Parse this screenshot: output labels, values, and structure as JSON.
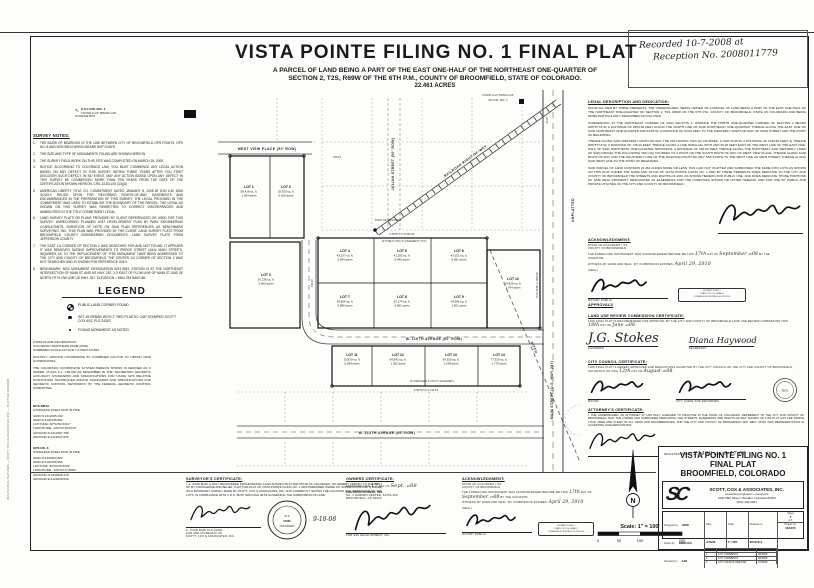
{
  "recording": {
    "line1": "Recorded 10-7-2008 at",
    "line2": "Reception No. 2008011779"
  },
  "header": {
    "title": "VISTA POINTE FILING NO. 1 FINAL PLAT",
    "subtitle1": "A PARCEL OF LAND BEING A PART OF THE EAST ONE-HALF OF THE NORTHEAST ONE-QUARTER OF",
    "subtitle2": "SECTION 2, T2S, R69W OF THE 6TH P.M., COUNTY OF BROOMFIELD, STATE OF COLORADO.",
    "acreage": "22.461 ACRES"
  },
  "corner_callout": {
    "line1": "N 1/4 COR. SEC. 2",
    "line2": "FOUND 3-1/4\" BRASS CAP",
    "line3": "IN RANGE BOX"
  },
  "plot_stamp": "08A37E FINAL PLAT.DWG — SCOTT, COX & ASSOCIATES, INC. — PLOTTED 9/18/2008",
  "survey_notes": {
    "heading": "SURVEY NOTES:",
    "items": [
      "THE BASIS OF BEARINGS IS THE LINE BETWEEN CITY OF BROOMFIELD GPS POINTS, GPS NO. 8 AND NGS BM13 WHICH BEARS N00°13'46\"E.",
      "THE SIZE AND TYPE OF MONUMENTS FOUND ARE SHOWN HEREON.",
      "THE SURVEY FIELD WORK ON THIS SITE WAS COMPLETED ON MARCH 18, 2008.",
      "NOTICE: ACCORDING TO COLORADO LAW, YOU MUST COMMENCE ANY LEGAL ACTION BASED ON ANY DEFECT IN THIS SURVEY WITHIN THREE YEARS AFTER YOU FIRST DISCOVER SUCH DEFECT. IN NO EVENT, MAY ANY ACTION BASED UPON ANY DEFECT IN THIS SURVEY BE COMMENCED MORE THAN TEN YEARS FROM THE DATE OF THE CERTIFICATION SHOWN HEREON. CRS-13-80-105 C(3)(a)",
      "AMERICAN LIBERTY TITLE CO. COMMITMENT DATED JANUARY 8, 2008 AT 8:00 A.M. WAS SOLELY RELIED UPON FOR RECORDED RIGHTS-OF-WAY, EASEMENTS AND ENCUMBRANCES IN THE PREPARATION OF THIS SURVEY. THE LEGAL PROVIDED IN THE COMMITMENT WAS USED TO ESTABLISH THE BOUNDARY OF THE PARCEL. THE LEGAL AS SHOWN ON THIS SURVEY WAS REWRITTEN TO CORRECT DISCREPANCIES AND AMBIGUITIES IN THE TITLE COMMITMENT LEGAL.",
      "LAND SURVEY PLATS OR PLANS PROVIDED BY CLIENT REFERENCED OR USED FOR THIS SURVEY: UNRECORDED PLANNED UNIT DEVELOPMENT PLAN BY PARK ENGINEERING CONSULTANTS, SURVEYOR OF NOTE ON SAID PLAN REFERENCED AS BENCHMARK SURVEYING, INC. THIS PLAN WAS PROVIDED BY THE CLIENT. LAND SURVEY PLATS FROM BROOMFIELD COUNTY ENGINEERING DOCUMENTS. LAND SURVEY PLATS FROM JEFFERSON COUNTY.",
      "THE EAST 1/4 CORNER OF SECTION 2 WAS SEARCHED FOR AND NOT FOUND. IT APPEARS IT WAS REMOVED DURING IMPROVEMENTS TO PIERCE STREET (AKA: MAIN STREET). INQUIRIES AS TO THE REPLACEMENT OF THIS MONUMENT HAVE BEEN ADDRESSED TO THE CITY AND COUNTY OF BROOMFIELD. THE CENTER 1/4 CORNER OF SECTION 2 WAS NOT SEARCHED AND IS SHOWN FOR REFERENCE ONLY.",
      "BENCHMARK: NGS MONUMENT DESIGNATION W33 BM3, STATION IS AT THE NORTHEAST INTERSECTION OF MAIN ST. AND US HWY. 287, 2.0' EAST OF FLOW LINE OF MAIN ST. AND 26' NORTH OF FLOW LINE US HWY. 287. ELEVATION = 5364.784 NAVD 88."
    ]
  },
  "legend": {
    "heading": "LEGEND",
    "items": [
      {
        "sym": "corner",
        "label": "PUBLIC LAND CORNER FOUND"
      },
      {
        "sym": "set",
        "label": "SET #5 REBAR WITH 1\" RED PLASTIC CAP STAMPED SCOTT COX ASC PLS 24302"
      },
      {
        "sym": "found",
        "label": "FOUND MONUMENT AS NOTED"
      }
    ]
  },
  "state_plane": {
    "paragraphs": [
      "STATE PLANE INFORMATION:\nCOLORADO NORTHERN ZONE (0502)\nCOMBINED SCALE FACTOR = 0.99971741581",
      "MULTIPLY GROUND COORDINATE BY COMBINED FACTOR TO OBTAIN GRID COORDINATES.",
      "THE COLORADO COORDINATE SYSTEM HEREON SHOWN IS DEFINED AS C ORDER, CLASS 2-1, 1:50,000 AS DESCRIBED IN THE \"GEOMETRIC GEODETIC ACCURACY STANDARDS AND SPECIFICATIONS FOR USING GPS RELATIVE POSITIONING TECHNIQUES AND/OR STANDARDS AND SPECIFICATIONS FOR GEODETIC CONTROL NETWORKS\" BY THE FEDERAL GEODETIC CONTROL COMMITTEE."
    ]
  },
  "benchmark_ngs": {
    "title": "NGS BM13",
    "type": "STAINLESS STEEL ROD IN PIPE",
    "lines": [
      "GRID N:1312025.190",
      "GRID E:3120145.862",
      "LATITUDE: 39°54'52.5310\"",
      "LONGITUDE: -105°04'18.5378\"",
      "GROUND N:1312367.786",
      "GROUND E:3121037.845"
    ]
  },
  "benchmark_gps8": {
    "title": "GPS NO. 8",
    "type": "STAINLESS STEEL ROD IN PIPE",
    "lines": [
      "GRID N:1309293.852",
      "GRID E:3120186.565",
      "LATITUDE: 39°54'25.5342\"",
      "LONGITUDE: -105°04'17.6884\"",
      "GROUND N:1309635.476",
      "GROUND E:3121068.536"
    ]
  },
  "plat": {
    "lots": [
      {
        "n": "LOT 1",
        "a": "59,416 sq. ft.",
        "ac": "1.364 acres",
        "x": 67,
        "y": 98
      },
      {
        "n": "LOT 2",
        "a": "18,303 sq. ft.",
        "ac": "0.420 acres",
        "x": 104,
        "y": 98
      },
      {
        "n": "LOT 3",
        "a": "26,136 sq. ft.",
        "ac": "0.600 acres",
        "x": 84,
        "y": 186
      },
      {
        "n": "LOT 4",
        "a": "43,237 sq. ft.",
        "ac": "0.993 acres",
        "x": 163,
        "y": 162
      },
      {
        "n": "LOT 5",
        "a": "41,182 sq. ft.",
        "ac": "0.945 acres",
        "x": 220,
        "y": 162
      },
      {
        "n": "LOT 6",
        "a": "43,151 sq. ft.",
        "ac": "0.991 acres",
        "x": 277,
        "y": 162
      },
      {
        "n": "LOT 7",
        "a": "38,604 sq. ft.",
        "ac": "0.886 acres",
        "x": 163,
        "y": 208
      },
      {
        "n": "LOT 8",
        "a": "43,174 sq. ft.",
        "ac": "0.991 acres",
        "x": 220,
        "y": 208
      },
      {
        "n": "LOT 9",
        "a": "43,586 sq. ft.",
        "ac": "1.001 acres",
        "x": 277,
        "y": 208
      },
      {
        "n": "LOT 10",
        "a": "76,826 sq. ft.",
        "ac": "1.764 acres",
        "x": 331,
        "y": 190
      },
      {
        "n": "LOT 11",
        "a": "25,870 sq. ft.",
        "ac": "0.594 acres",
        "x": 170,
        "y": 266
      },
      {
        "n": "LOT 12",
        "a": "54,542 sq. ft.",
        "ac": "1.252 acres",
        "x": 216,
        "y": 266
      },
      {
        "n": "LOT 13",
        "a": "54,350 sq. ft.",
        "ac": "1.248 acres",
        "x": 269,
        "y": 266
      },
      {
        "n": "LOT 14",
        "a": "77,330 sq. ft.",
        "ac": "1.775 acres",
        "x": 317,
        "y": 266
      }
    ],
    "streets": [
      {
        "t": "WEST VIEW PLACE  (50' ROW)",
        "x": 85,
        "y": 60,
        "r": 0
      },
      {
        "t": "W. 116TH AVENUE  (60' ROW)",
        "x": 252,
        "y": 250,
        "r": 0
      },
      {
        "t": "W. 115TH AVENUE  (60' ROW)",
        "x": 205,
        "y": 344,
        "r": 0
      },
      {
        "t": "JULIAN STREET  (50' ROW)",
        "x": 212,
        "y": 74,
        "r": -90
      },
      {
        "t": "MAIN STREET  (U.S. HWY 287)",
        "x": 371,
        "y": 300,
        "r": -90
      },
      {
        "t": "RAILROAD RIGHT-OF-WAY",
        "x": 284,
        "y": 72,
        "r": -36
      },
      {
        "t": "DITCH",
        "x": 351,
        "y": 258,
        "r": 66
      },
      {
        "t": "UNPLATTED",
        "x": 392,
        "y": 120,
        "r": -90
      }
    ],
    "dims": [
      {
        "t": "N 89°57'14\" W   662.93'",
        "x": 220,
        "y": 145,
        "r": 0
      },
      {
        "t": "330.00'",
        "x": 131,
        "y": 193,
        "r": -90
      },
      {
        "t": "S 89°57'14\" E   745.20'",
        "x": 244,
        "y": 301,
        "r": 0
      },
      {
        "t": "N 00°13'46\" E   1330.60'",
        "x": 356,
        "y": 195,
        "r": -90
      },
      {
        "t": "POINT OF BEGINNING",
        "x": 206,
        "y": 131,
        "r": 0
      },
      {
        "t": "10' PUBLIC UTILITY EASEMENT (TYP.)",
        "x": 222,
        "y": 152,
        "r": 0
      },
      {
        "t": "20' DRAINAGE & UTILITY EASEMENT",
        "x": 250,
        "y": 292,
        "r": 0
      },
      {
        "t": "FOUND 3-1/4\" BRASS CAP",
        "x": 316,
        "y": 6,
        "r": 0
      },
      {
        "t": "NE COR. SEC. 2",
        "x": 316,
        "y": 11,
        "r": 0
      },
      {
        "t": "60.00'",
        "x": 366,
        "y": 30,
        "r": -90
      },
      {
        "t": "330.00'",
        "x": 155,
        "y": 68,
        "r": 0
      }
    ],
    "north_label": "N",
    "scale_text": "Scale: 1\" = 100'",
    "scale_ticks": [
      "0",
      "50",
      "100",
      "200"
    ]
  },
  "legal": {
    "heading": "LEGAL DESCRIPTION AND DEDICATION:",
    "paragraphs": [
      "KNOW ALL MEN BY THESE PRESENTS, THE UNDERSIGNED, BEING OWNER OF A PARCEL OF LAND BEING A PART OF THE EAST ONE-HALF OF THE NORTHEAST ONE-QUARTER OF SECTION 2, T2S, R69W OF THE 6TH P.M., COUNTY OF BROOMFIELD, STATE OF COLORADO AND BEING MORE PARTICULARLY DESCRIBED AS FOLLOWS:",
      "COMMENCING AT THE NORTHEAST CORNER OF SAID SECTION 2, WHENCE THE NORTH ONE-QUARTER CORNER OF SECTION 2 BEARS N89°57'14\"W, A DISTANCE OF 2654.83 FEET ALONG THE NORTH LINE OF SAID NORTHEAST ONE-QUARTER; THENCE ALONG THE EAST LINE OF SAID NORTHEAST ONE-QUARTER S00°13'46\"W, A DISTANCE OF 60.00 FEET TO THE WESTERLY RIGHT-OF-WAY OF MAIN STREET AND THE POINT OF BEGINNING.",
      "THENCE ALONG SAID WESTERLY RIGHT-OF-WAY THE FOLLOWING TWO (2) COURSES: 1) S00°13'46\"W, A DISTANCE OF 1330.60 FEET; 2) THENCE N89°57'14\"W, A DISTANCE OF 745.20 FEET; THENCE ALONG A LINE PARALLEL WITH AND 30.00 FEET EAST OF THE WEST LINE OF THE EAST ONE-HALF OF SAID NORTHEAST ONE-QUARTER N00°02'46\"E, A DISTANCE OF 330.00 FEET; THENCE ALONG THE NORTHERLY AND WESTERLY LINES OF SAID PARCEL THE FOLLOWING TEN (10) COURSES TO A POINT ON THE SOUTH RIGHT-OF-WAY OF WEST VIEW PLACE; THENCE ALONG SAID RIGHT-OF-WAY AND THE SOUTHERLY LINE OF THE RAILROAD RIGHT-OF-WAY S52°14'00\"E TO THE WEST LINE OF MAIN STREET; THENCE ALONG SAID WEST LINE TO THE POINT OF BEGINNING.",
      "SAID PARCEL OF LAND CONTAINS 22.461 ACRES MORE OR LESS. HAS LAID OUT, PLATTED AND SUBDIVIDED THE SAME INTO LOTS AS SHOWN ON THIS PLAT UNDER THE NAME AND STYLE OF VISTA POINTE FILING NO. 1 AND BY THESE PRESENTS DOES DEDICATE TO THE CITY AND COUNTY OF BROOMFIELD THE STREETS AND RIGHTS-OF-WAY AS SHOWN HEREON FOR PUBLIC USE, AND DOES DEDICATE THOSE PORTIONS OF SAID REAL PROPERTY DESIGNATED AS EASEMENTS FOR THE PURPOSES SHOWN OR NOTED HEREON, AND FOR USE BY PUBLIC AND PRIVATE UTILITIES OF THE CITY AND COUNTY OF BROOMFIELD."
    ]
  },
  "acknowledgment": {
    "heading": "ACKNOWLEDGMENT:",
    "state": "STATE OF COLORADO",
    "county": "COUNTY OF BROOMFIELD",
    "ss": "} SS.",
    "body_pre": "THE FOREGOING INSTRUMENT WAS ACKNOWLEDGED BEFORE ME THIS",
    "day": "17th",
    "body_mid": "DAY OF",
    "month": "September",
    "body_yr": ", 20",
    "year": "08",
    "body_post": "BY THE SIGNATOR.",
    "witness": "WITNESS MY HAND AND SEAL.",
    "expires_label": "MY COMMISSION EXPIRES:",
    "expires": "April 29, 2010",
    "seal": "(SEAL)",
    "notary_caption": "NOTARY PUBLIC"
  },
  "notary_stamp": {
    "lines": [
      "NOTARY PUBLIC",
      "STATE OF COLORADO",
      "COMMISSION EXPIRES 04-29-2010"
    ]
  },
  "approvals_heading": "APPROVALS",
  "lurc": {
    "heading": "LAND USE REVIEW COMMISSION CERTIFICATE:",
    "body_pre": "THIS FINAL PLAT IS RECOMMENDED FOR APPROVAL BY THE CITY AND COUNTY OF BROOMFIELD LAND USE REVIEW COMMISSION THIS",
    "day": "18th",
    "body_mid": "DAY OF",
    "month": "June",
    "body_yr": ", 20",
    "year": "08",
    "chairman_sig": "J.G. Stokes",
    "chairman_caption": "CHAIRMAN",
    "secretary_sig": "Diana Haywood",
    "secretary_caption": "SECRETARY"
  },
  "council": {
    "heading": "CITY COUNCIL CERTIFICATE:",
    "body_pre": "THIS FINAL PLAT IS HEREBY APPROVED AND DEDICATIONS ACCEPTED BY THE CITY COUNCIL OF THE CITY AND COUNTY OF BROOMFIELD, COLORADO ON THIS",
    "day": "12th",
    "body_mid": "DAY OF",
    "month": "August",
    "body_yr": ", 20",
    "year": "08",
    "mayor_caption": "MAYOR",
    "clerk_caption": "CITY CLERK AND RECORDER",
    "seal_label": "SEAL"
  },
  "attorney": {
    "heading": "ATTORNEY'S CERTIFICATE:",
    "body": "I, THE UNDERSIGNED, AN ATTORNEY AT LAW DULY LICENSED TO PRACTICE IN THE STATE OF COLORADO, REPRESENT TO THE CITY AND COUNTY OF BROOMFIELD THAT THE OWNER AND SUBDIVIDER DEDICATING THE STREETS, EASEMENTS AND RIGHTS-OF-WAY SHOWN ON THIS PLAT HAS FEE SIMPLE TITLE, FREE AND CLEAR OF ALL LIENS AND ENCUMBRANCES, AND THE CITY AND COUNTY OF BROOMFIELD MAY RELY UPON THIS REPRESENTATION IN ACCEPTING SAID DEDICATIONS.",
    "reg_label": "REGISTRATION NO.",
    "reg_no": "21409",
    "date_label": "DATE:",
    "date": "9-17-08"
  },
  "surveyor_cert": {
    "heading": "SURVEYOR'S CERTIFICATE:",
    "body": "I, A. JOHN BURI, A DULY REGISTERED PROFESSIONAL LAND SURVEYOR IN THE STATE OF COLORADO, DO HEREBY CERTIFY TO THE BEST OF MY KNOWLEDGE AND BELIEF, THAT THIS PLAT OF VISTA POINTE FILING NO. 1 WAS PREPARED UNDER MY SUPERVISION AND IS BASED ON A BOUNDARY SURVEY MADE BY SCOTT, COX & ASSOCIATES, INC. AND CORRECTLY SHOWS THE LOCATION AND DIMENSIONS OF THE LOTS, IN COMPLIANCE WITH C.R.S. 38-50 THROUGH 38-53 GOVERNING THE SUBDIVISION OF LAND.",
    "date": "9-18-08",
    "name_line1": "A. JOHN BURI PLS 24302",
    "name_line2": "FOR AND ON BEHALF OF",
    "name_line3": "SCOTT, COX & ASSOCIATES, INC.",
    "seal_line1": "PLS",
    "seal_line2": "24302",
    "seal_line3": "COLORADO"
  },
  "owner_cert": {
    "heading": "OWNERS CERTIFICATE:",
    "exec_pre": "EXECUTED THIS",
    "day": "17",
    "exec_mid": "DAY OF",
    "month": "Sept.",
    "exec_yr": ", 20",
    "year": "08",
    "company": "S&S DEVELOPMENT, INC.",
    "address": "NO. 4 GARDEN CENTER, SUITE 200",
    "city": "BROOMFIELD, CO 80020",
    "sig_caption": "FOR S&S DEVELOPMENT, INC."
  },
  "titleblock": {
    "title_line1": "VISTA POINTE FILING NO. 1",
    "title_line2": "FINAL PLAT",
    "title_line3": "BROOMFIELD, COLORADO",
    "firm_logo": "SC",
    "firm_name": "SCOTT, COX & ASSOCIATES, INC.",
    "firm_sub": "consulting engineers  •  surveyors",
    "firm_addr": "1530 55th Street  •  Boulder, Colorado 80303",
    "firm_phone": "(303) 444-3051",
    "designed_label": "Designed by",
    "designed": "BMR",
    "drawn_label": "Drawn by",
    "drawn": "BMR/JAS",
    "checked_label": "Checked by",
    "checked": "AJB",
    "date_label": "Date",
    "date": "4/16/08",
    "scale_label": "Scale",
    "scale": "1\"=100'",
    "dwg_label": "Drawing no.",
    "dwg": "08A37E-3",
    "sheet_label": "Sheet",
    "sheet": "1",
    "of_label": "of 1",
    "proj_label": "Project no.",
    "proj": "08A37E",
    "rev_head": [
      "Revision",
      "Description",
      "Date"
    ],
    "revisions": [
      [
        "1",
        "CITY COMMENTS",
        "05/16/08"
      ],
      [
        "2",
        "CITY COMMENTS",
        "06/30/08"
      ],
      [
        "3",
        "CITY COUNCIL MEETING",
        "07/29/08"
      ]
    ]
  }
}
